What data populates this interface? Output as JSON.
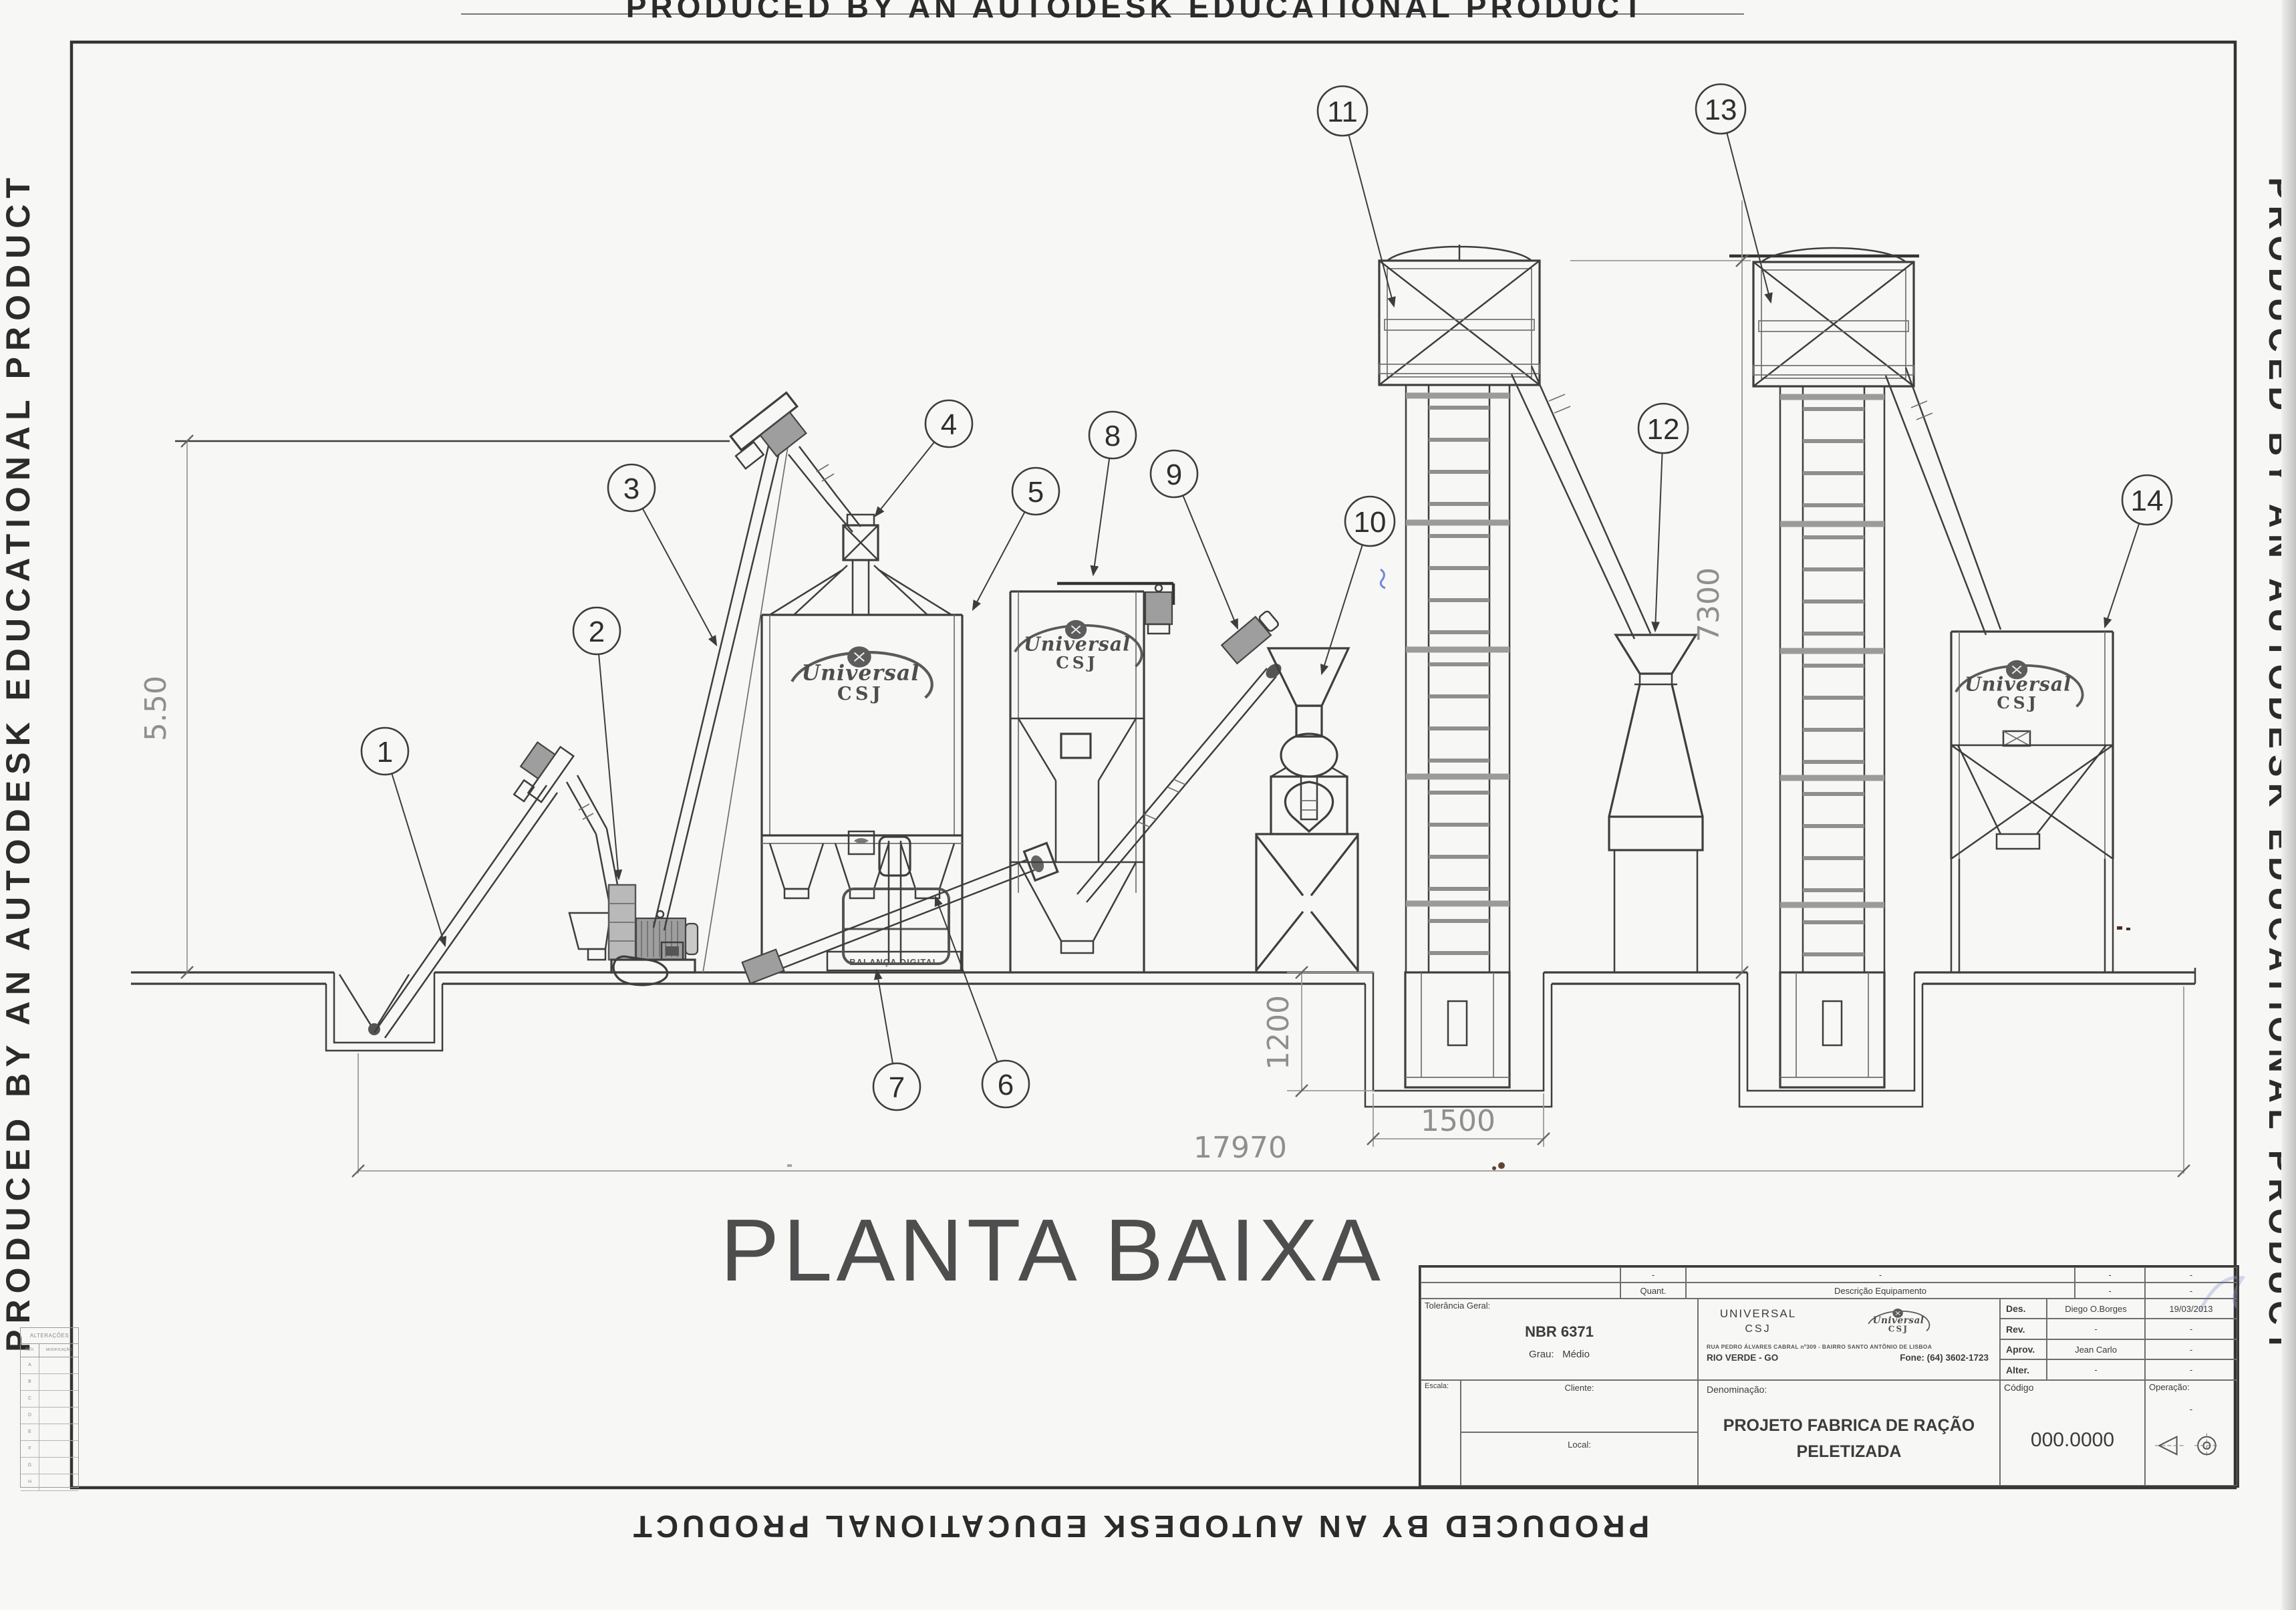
{
  "watermark": {
    "text": "PRODUCED BY AN AUTODESK EDUCATIONAL PRODUCT"
  },
  "drawing": {
    "title": "PLANTA BAIXA"
  },
  "machine_labels": {
    "scale": "BALANÇA DIGITAL"
  },
  "logo": {
    "line1": "Universal",
    "line2": "CSJ"
  },
  "dims": {
    "d550": "5.50",
    "d7300": "7300",
    "d1200": "1200",
    "d1500": "1500",
    "d17970": "17970"
  },
  "callouts": [
    {
      "n": "1"
    },
    {
      "n": "2"
    },
    {
      "n": "3"
    },
    {
      "n": "4"
    },
    {
      "n": "5"
    },
    {
      "n": "6"
    },
    {
      "n": "7"
    },
    {
      "n": "8"
    },
    {
      "n": "9"
    },
    {
      "n": "10"
    },
    {
      "n": "11"
    },
    {
      "n": "12"
    },
    {
      "n": "13"
    },
    {
      "n": "14"
    }
  ],
  "rev_table": {
    "title": "ALTERAÇÕES",
    "col1": "REV.",
    "col2": "MODIFICAÇÃO",
    "rows": [
      "A",
      "B",
      "C",
      "D",
      "E",
      "F",
      "G",
      "H"
    ]
  },
  "title_block": {
    "strip_row1": {
      "c1": "-",
      "c2": "-",
      "c3": "-",
      "c4": "-"
    },
    "strip_row2": {
      "quant": "Quant.",
      "desc": "Descrição Equipamento",
      "c3": "-",
      "c4": "-"
    },
    "tol_label": "Tolerância Geral:",
    "norm": "NBR 6371",
    "grau_label": "Grau:",
    "grau_value": "Médio",
    "company1": "UNIVERSAL",
    "company2": "CSJ",
    "address": "RUA PEDRO ÁLVARES CABRAL nº309 - BAIRRO SANTO ANTÔNIO DE LISBOA",
    "city": "RIO VERDE - GO",
    "phone": "Fone: (64) 3602-1723",
    "rows": [
      [
        "Des.",
        "Diego O.Borges",
        "19/03/2013"
      ],
      [
        "Rev.",
        "-",
        "-"
      ],
      [
        "Aprov.",
        "Jean Carlo",
        "-"
      ],
      [
        "Alter.",
        "-",
        "-"
      ]
    ],
    "escala": "Escala:",
    "cliente": "Cliente:",
    "local": "Local:",
    "denom_label": "Denominação:",
    "denom1": "PROJETO FABRICA DE RAÇÃO",
    "denom2": "PELETIZADA",
    "codigo_label": "Código",
    "codigo": "000.0000",
    "oper_label": "Operação:",
    "oper_value": "-"
  }
}
